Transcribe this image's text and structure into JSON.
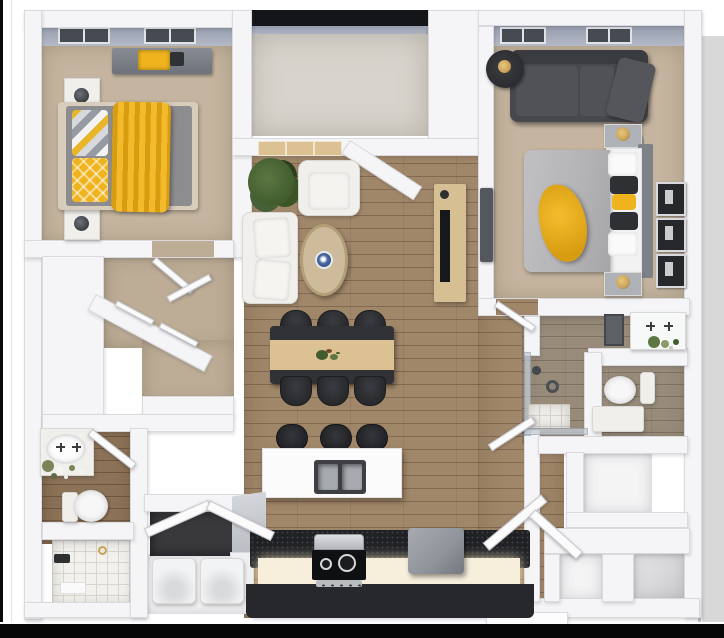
{
  "image": {
    "kind": "3d-floor-plan-render",
    "view": "top-down isometric",
    "unit_type": "2-bedroom 2-bath apartment",
    "visible_text": null
  },
  "palette": {
    "wall": "#f5f5f7",
    "wallEdge": "#dadade",
    "wallFace": "#959cac",
    "wallFaceLight": "#b3b9c5",
    "railing": "#141518",
    "carpet": "#c5b5a0",
    "carpetCloset": "#bdad97",
    "concrete": "#d8d4cd",
    "wood": "#a1876a",
    "woodSeam": "#8a7053",
    "woodBath": "#988b7a",
    "woodDark": "#8c7257",
    "tile": "#f2f1ed",
    "tileLine": "#d8d5cf",
    "white": "#f0efec",
    "cream": "#e4e1db",
    "yellow": "#eeb31d",
    "yellowDeep": "#d89c10",
    "darkSofa": "#46484c",
    "darkChair": "#27292c",
    "tableDark": "#303236",
    "runner": "#dcc192",
    "consoleTan": "#d6bf93",
    "duvet": "#b5b5b8",
    "mattress": "#8d8d90",
    "steel": "#a7abb0",
    "counterBlack": "#1f2124",
    "cabinetGlow": "#f7efdc",
    "baseBlack": "#27282b",
    "fridge": "#8f949a",
    "green": "#415c2e",
    "greenLight": "#5d7742",
    "blue": "#4a66a0",
    "gold": "#c8a35c",
    "glass": "#c3ccd6"
  },
  "rooms": {
    "bedroom_primary": {
      "position": "top-left",
      "floor": "carpet",
      "furniture": [
        "dresser with yellow decor",
        "bed with gray mattress",
        "yellow throw blanket",
        "patterned pillow",
        "yellow diamond pillow",
        "nightstand x2",
        "table lamp x2"
      ],
      "windows": 2
    },
    "balcony": {
      "position": "top-center",
      "floor": "concrete",
      "furniture": [],
      "railing": true
    },
    "bedroom_secondary": {
      "position": "top-right",
      "floor": "carpet",
      "furniture": [
        "dark sectional sofa",
        "round side table",
        "glass side table",
        "bed with gray duvet",
        "yellow throw",
        "pillows white/dark/yellow",
        "headboard",
        "nightstand x2",
        "gold lamp x2",
        "wall frames x3",
        "dark dresser"
      ],
      "windows": 2
    },
    "living_room": {
      "position": "center-left",
      "floor": "wood",
      "furniture": [
        "potted plant",
        "white armchair",
        "white sofa",
        "oval coffee table",
        "blue ceramic bowl",
        "tan tv console"
      ],
      "windows": 3
    },
    "dining_area": {
      "position": "center",
      "floor": "wood",
      "furniture": [
        "dark dining table",
        "tan table runner",
        "plant centerpiece"
      ],
      "chairs": 6
    },
    "kitchen": {
      "position": "bottom-center",
      "floor": "wood",
      "furniture": [
        "white island",
        "double stainless sink",
        "bar stool x3",
        "black countertop",
        "lit cabinet fronts",
        "range hood",
        "black cooktop",
        "refrigerator",
        "corner counter"
      ],
      "stools": 3
    },
    "bathroom_left": {
      "position": "bottom-left",
      "floor": "wood-tile",
      "furniture": [
        "vanity with sink and flowers",
        "toilet",
        "tiled tub with faucet and towel"
      ]
    },
    "bathroom_right": {
      "position": "middle-right",
      "floor": "gray-wood",
      "furniture": [
        "vanity with plant",
        "dark mirror",
        "toilet",
        "glass shower with drain",
        "white bench"
      ]
    },
    "walk_in_closet": {
      "position": "middle-left",
      "floor": "carpet",
      "features": [
        "angled wall",
        "open double doors",
        "shelf band"
      ]
    },
    "laundry_closet": {
      "position": "bottom-left-center",
      "appliances": [
        "washer",
        "dryer"
      ],
      "features": [
        "utility closet with angled open doors"
      ]
    },
    "entry": {
      "position": "bottom-right",
      "floor": "wood",
      "features": [
        "open door panels",
        "linen closet",
        "coat closets x2",
        "entry stoop"
      ]
    }
  },
  "counts": {
    "dining_chairs": 6,
    "bar_stools": 3,
    "wall_frames": 3,
    "bedroom_windows": 4,
    "appliances": 4
  }
}
